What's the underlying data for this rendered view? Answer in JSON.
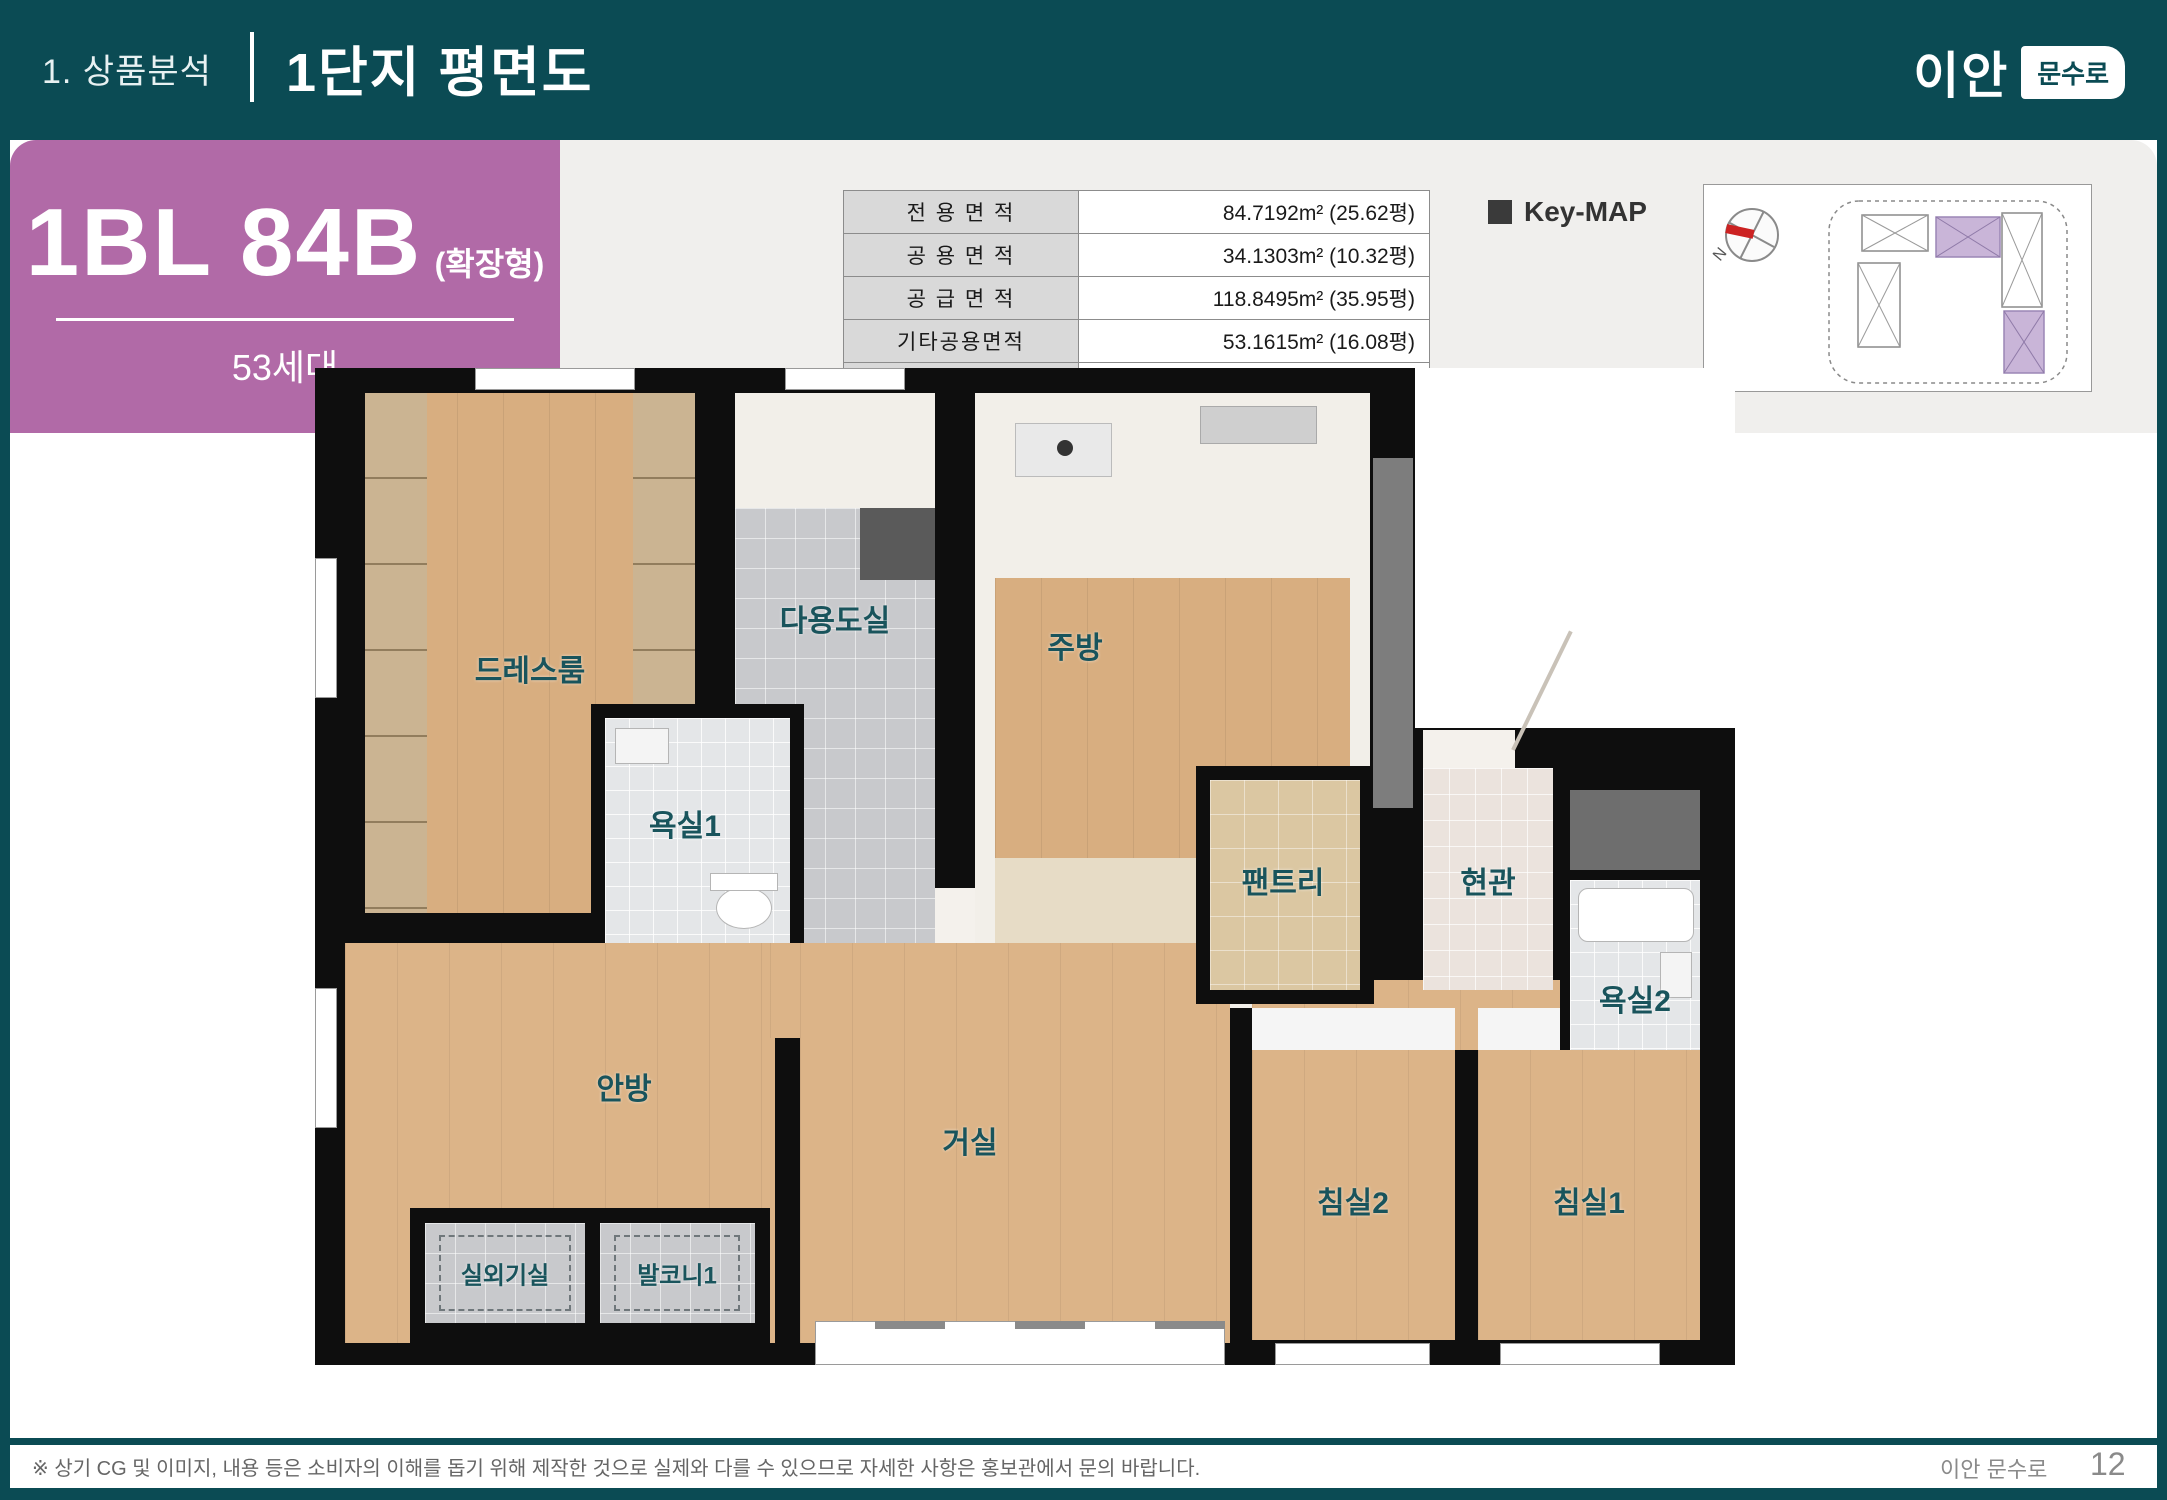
{
  "header": {
    "section": "1. 상품분석",
    "title": "1단지 평면도",
    "logo": {
      "brand": "이안",
      "badge": "문수로"
    }
  },
  "unit": {
    "code": "1BL 84B",
    "type_suffix": "(확장형)",
    "households": "53세대"
  },
  "area_table": {
    "rows": [
      {
        "label": "전 용 면 적",
        "value": "84.7192m² (25.62평)"
      },
      {
        "label": "공 용 면 적",
        "value": "34.1303m² (10.32평)"
      },
      {
        "label": "공 급 면 적",
        "value": "118.8495m² (35.95평)"
      },
      {
        "label": "기타공용면적",
        "value": "53.1615m² (16.08평)"
      },
      {
        "label": "계 약 면 적",
        "value": "172.0111m² (52.03평)"
      }
    ]
  },
  "keymap": {
    "title": "Key-MAP",
    "north_label": "N"
  },
  "floorplan": {
    "rooms": {
      "dressroom": "드레스룸",
      "utility": "다용도실",
      "kitchen": "주방",
      "bath1": "욕실1",
      "pantry": "팬트리",
      "entrance": "현관",
      "bath2": "욕실2",
      "master": "안방",
      "living": "거실",
      "bed2": "침실2",
      "bed1": "침실1",
      "ac_room": "실외기실",
      "balcony1": "발코니1"
    }
  },
  "footer": {
    "disclaimer": "※ 상기 CG 및 이미지, 내용 등은 소비자의 이해를 돕기 위해 제작한 것으로 실제와 다를 수 있으므로 자세한 사항은 홍보관에서 문의 바랍니다.",
    "project": "이안 문수로",
    "page": "12"
  },
  "colors": {
    "header_teal": "#0b4b54",
    "accent_purple": "#b16aa7",
    "room_label_teal": "#19545c",
    "panel_gray": "#f0efed"
  }
}
